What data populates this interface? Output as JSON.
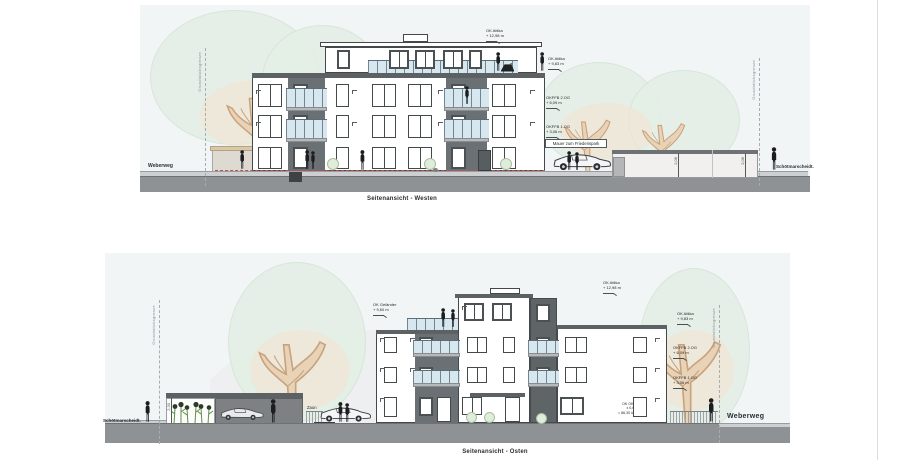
{
  "west": {
    "title": "Seitenansicht - Westen",
    "street_left": "Weberweg",
    "street_right": "Schötmarscheidt.",
    "boundary": "Grundstücksgrenze",
    "wall_label": "Mauer zum Friedenspark",
    "wall_height_dim": "2,06",
    "elev": {
      "attika_top": [
        "OK Attika",
        "+ 12,98 m"
      ],
      "attika_mid": [
        "OK Attika",
        "+ 9,83 m"
      ],
      "ffb2": [
        "OKFFB 2.OG",
        "+ 6,09 m"
      ],
      "ffb1": [
        "OKFFB 1.OG",
        "+ 3,06 m"
      ]
    }
  },
  "east": {
    "title": "Seitenansicht  - Osten",
    "street_left": "Schötmarscheidt.",
    "street_right": "Weberweg",
    "boundary": "Grundstücksgrenze",
    "zaun_label": "Zaun",
    "slope_label": "2,5 % Gefälle",
    "carport_height_dim": "2,30",
    "elev": {
      "gelaender": [
        "OK Geländer",
        "+ 9,60 m"
      ],
      "attika_top": [
        "OK Attika",
        "+ 12,98 m"
      ],
      "attika_mid": [
        "OK Attika",
        "+ 9,83 m"
      ],
      "ffb2": [
        "OKFFB 2.OG",
        "+ 6,09 m"
      ],
      "ffb1": [
        "OKFFB 1.OG",
        "+ 3,06 m"
      ],
      "ground": [
        "OK OKFFB",
        "± 0,00 m",
        "= 86,30 ü. NN"
      ]
    }
  },
  "colors": {
    "facade": "#ffffff",
    "accent_dark": "#5c6164",
    "balcony_glass": "#d7e7f0",
    "ground": "#8f9294",
    "tree_canopy": "#e4efe6",
    "tree_trunk": "#e8d3b9",
    "red_line": "#c0504a"
  }
}
